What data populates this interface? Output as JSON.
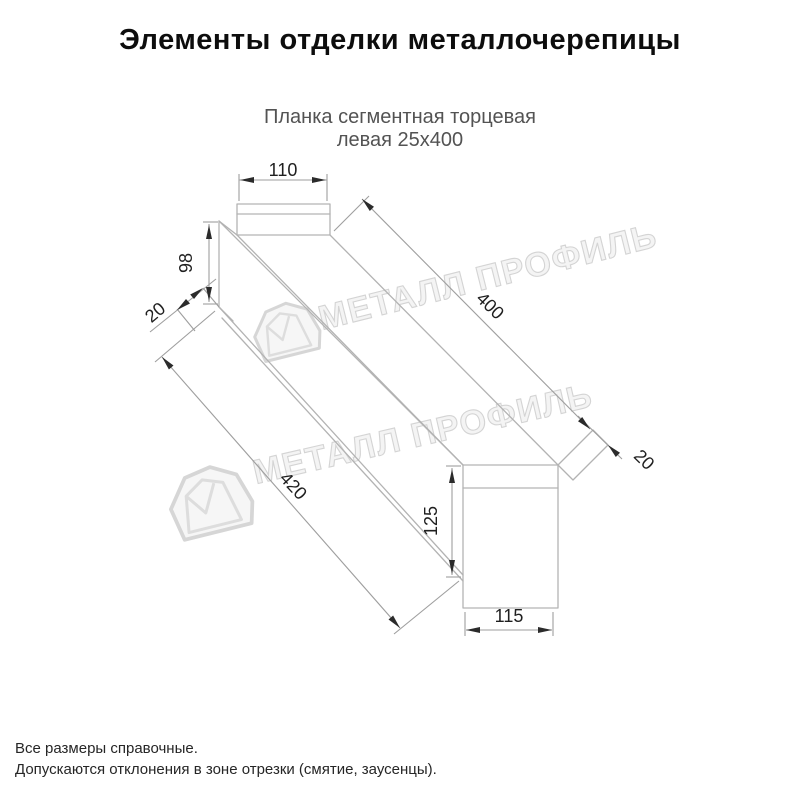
{
  "header": {
    "title": "Элементы отделки металлочерепицы"
  },
  "product": {
    "name_line1": "Планка сегментная торцевая",
    "name_line2": "левая 25х400"
  },
  "dimensions": {
    "flange_width": "110",
    "left_end_height": "98",
    "left_hem": "20",
    "length_top": "400",
    "length_bottom": "420",
    "end_face_height": "125",
    "end_face_width": "115",
    "right_hem": "20"
  },
  "watermark": {
    "text": "МЕТАЛЛ ПРОФИЛЬ",
    "logo": "metal-profil-house-logo"
  },
  "footer": {
    "note1": "Все размеры справочные.",
    "note2": "Допускаются отклонения в зоне отрезки (смятие, заусенцы)."
  },
  "colors": {
    "drawing_line": "#b3b3b3",
    "dimension_line": "#9e9e9e",
    "ink": "#1f1f1f",
    "subtitle_text": "#535353",
    "watermark_gray": "#cdcdcd"
  }
}
